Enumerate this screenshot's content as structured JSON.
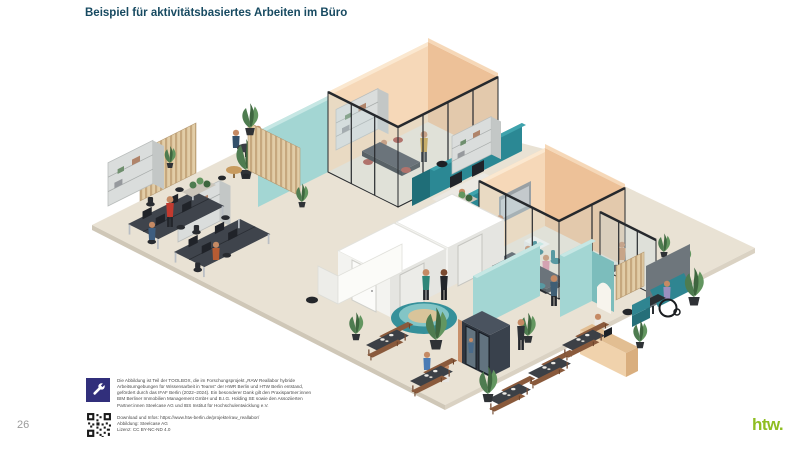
{
  "slide": {
    "title": "Beispiel für aktivitätsbasiertes Arbeiten im Büro",
    "page_number": "26"
  },
  "footer": {
    "badge_icon": "wrench-icon",
    "credit_lines": [
      "Die Abbildung ist Teil der TOOLBOX, die im Forschungsprojekt „RAW Reallabor hybride",
      "Arbeitsumgebungen für Wissensarbeit in Teams\" der HWR Berlin und HTW Berlin entstand,",
      "gefördert durch das IFAF Berlin (2022–2024). Ein besonderer Dank gilt den Praxispartner:innen",
      "BIM Berliner Immobilien Management GmbH und B.I.G. Holding SE sowie den Assoziierten",
      "Partner:innen Steelcase AG und IBS Institut für Hochschulentwicklung e.V."
    ],
    "download_line": "Download und Infos: https://www.htw-berlin.de/projekte/raw_reallabor/",
    "illustration_credit": "Abbildung: Steelcase AG",
    "license_line": "Lizenz: CC BY-NC-ND 4.0"
  },
  "logo": {
    "text": "htw.",
    "color": "#8FBE22"
  },
  "illustration": {
    "type": "isometric-office-plan",
    "palette": {
      "floor": "#E9E2D4",
      "wall_peach": "#F6D8B8",
      "wall_peach_dark": "#EDC198",
      "wall_teal_light": "#A3D6D3",
      "panel_teal": "#2B8894",
      "booth_white": "#F3F3F0",
      "wood_bench": "#8A5A3C",
      "frame_dark": "#26292D",
      "plant_green": "#4E7C50",
      "accent_title": "#174A61"
    },
    "zones": [
      "team room",
      "open plan desks",
      "focus booths",
      "quiet phone booth",
      "lounge pod",
      "canteen benches",
      "meeting room",
      "glass office",
      "reception",
      "accessible workstation"
    ]
  }
}
